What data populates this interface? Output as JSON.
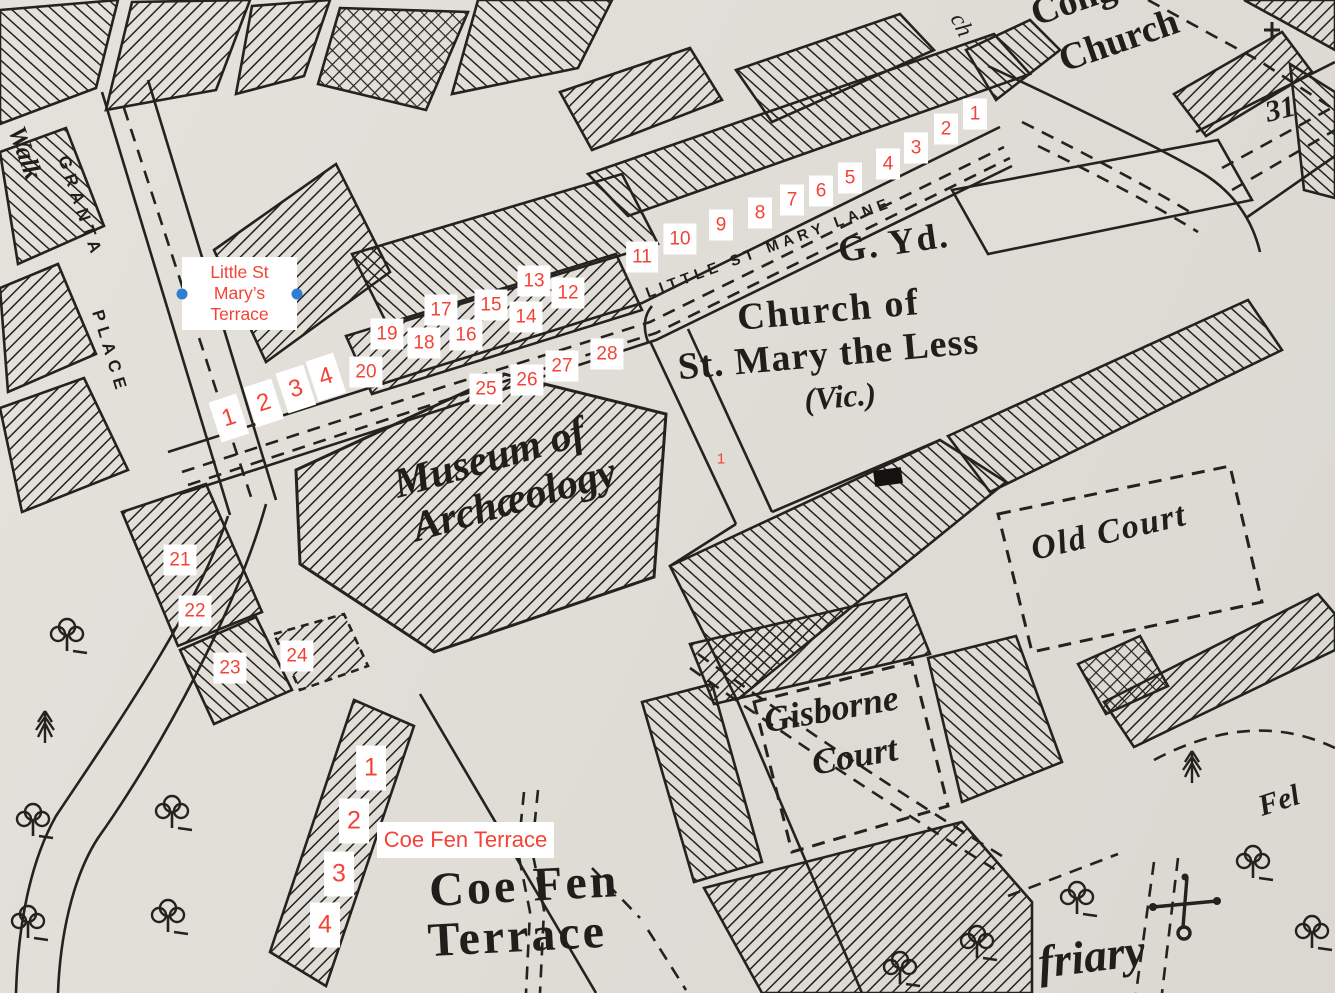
{
  "canvas": {
    "width": 1335,
    "height": 993,
    "paper_color": "#e1ded8",
    "ink_color": "#201e1b"
  },
  "style": {
    "annotation_red": "#f44336",
    "selection_handle_blue": "#2e7fd1",
    "marker_background": "#ffffff"
  },
  "map_labels": {
    "walk_fragment": "Walk",
    "granta": "GRANTA",
    "place": "PLACE",
    "little_st_mary_lane": "LITTLE ST MARY LANE",
    "g_yd": "G. Yd.",
    "church_of": "Church of",
    "st_mary_the_less": "St. Mary the Less",
    "vic": "(Vic.)",
    "museum_line1": "Museum of",
    "museum_line2": "Archæology",
    "old_court": "Old Court",
    "gisborne_line1": "Gisborne",
    "gisborne_line2": "Court",
    "coe_fen_line1": "Coe Fen",
    "coe_fen_line2": "Terrace",
    "friary": "friary",
    "fel_fragment": "Fel",
    "cong_fragment": "Cong",
    "church_top": "Church",
    "ch_fragment": "ch",
    "number_31": "31"
  },
  "overlays": {
    "little_st_marys_terrace": {
      "text_lines": [
        "Little St",
        "Mary’s",
        "Terrace"
      ]
    },
    "coe_fen_terrace": {
      "text": "Coe Fen Terrace"
    },
    "markers_small": [
      {
        "n": "1",
        "x": 975,
        "y": 114
      },
      {
        "n": "2",
        "x": 946,
        "y": 129
      },
      {
        "n": "3",
        "x": 916,
        "y": 148
      },
      {
        "n": "4",
        "x": 888,
        "y": 164
      },
      {
        "n": "5",
        "x": 850,
        "y": 178
      },
      {
        "n": "6",
        "x": 821,
        "y": 191
      },
      {
        "n": "7",
        "x": 792,
        "y": 200
      },
      {
        "n": "8",
        "x": 760,
        "y": 213
      },
      {
        "n": "9",
        "x": 721,
        "y": 225
      },
      {
        "n": "10",
        "x": 680,
        "y": 239
      },
      {
        "n": "11",
        "x": 642,
        "y": 257
      },
      {
        "n": "12",
        "x": 568,
        "y": 293
      },
      {
        "n": "13",
        "x": 534,
        "y": 281
      },
      {
        "n": "14",
        "x": 526,
        "y": 317
      },
      {
        "n": "15",
        "x": 491,
        "y": 305
      },
      {
        "n": "16",
        "x": 466,
        "y": 335
      },
      {
        "n": "17",
        "x": 441,
        "y": 310
      },
      {
        "n": "18",
        "x": 424,
        "y": 343
      },
      {
        "n": "19",
        "x": 387,
        "y": 334
      },
      {
        "n": "20",
        "x": 366,
        "y": 372
      },
      {
        "n": "21",
        "x": 180,
        "y": 560
      },
      {
        "n": "22",
        "x": 195,
        "y": 611
      },
      {
        "n": "23",
        "x": 230,
        "y": 668
      },
      {
        "n": "24",
        "x": 297,
        "y": 656
      },
      {
        "n": "25",
        "x": 486,
        "y": 389
      },
      {
        "n": "26",
        "x": 527,
        "y": 380
      },
      {
        "n": "27",
        "x": 562,
        "y": 366
      },
      {
        "n": "28",
        "x": 607,
        "y": 354
      }
    ],
    "markers_tilted": [
      {
        "n": "1",
        "x": 229,
        "y": 418
      },
      {
        "n": "2",
        "x": 264,
        "y": 403
      },
      {
        "n": "3",
        "x": 296,
        "y": 389
      },
      {
        "n": "4",
        "x": 326,
        "y": 377
      }
    ],
    "markers_coefen": [
      {
        "n": "1",
        "x": 371,
        "y": 768
      },
      {
        "n": "2",
        "x": 354,
        "y": 821
      },
      {
        "n": "3",
        "x": 339,
        "y": 874
      },
      {
        "n": "4",
        "x": 325,
        "y": 925
      }
    ],
    "marker_plain": {
      "n": "1",
      "x": 721,
      "y": 459
    }
  }
}
